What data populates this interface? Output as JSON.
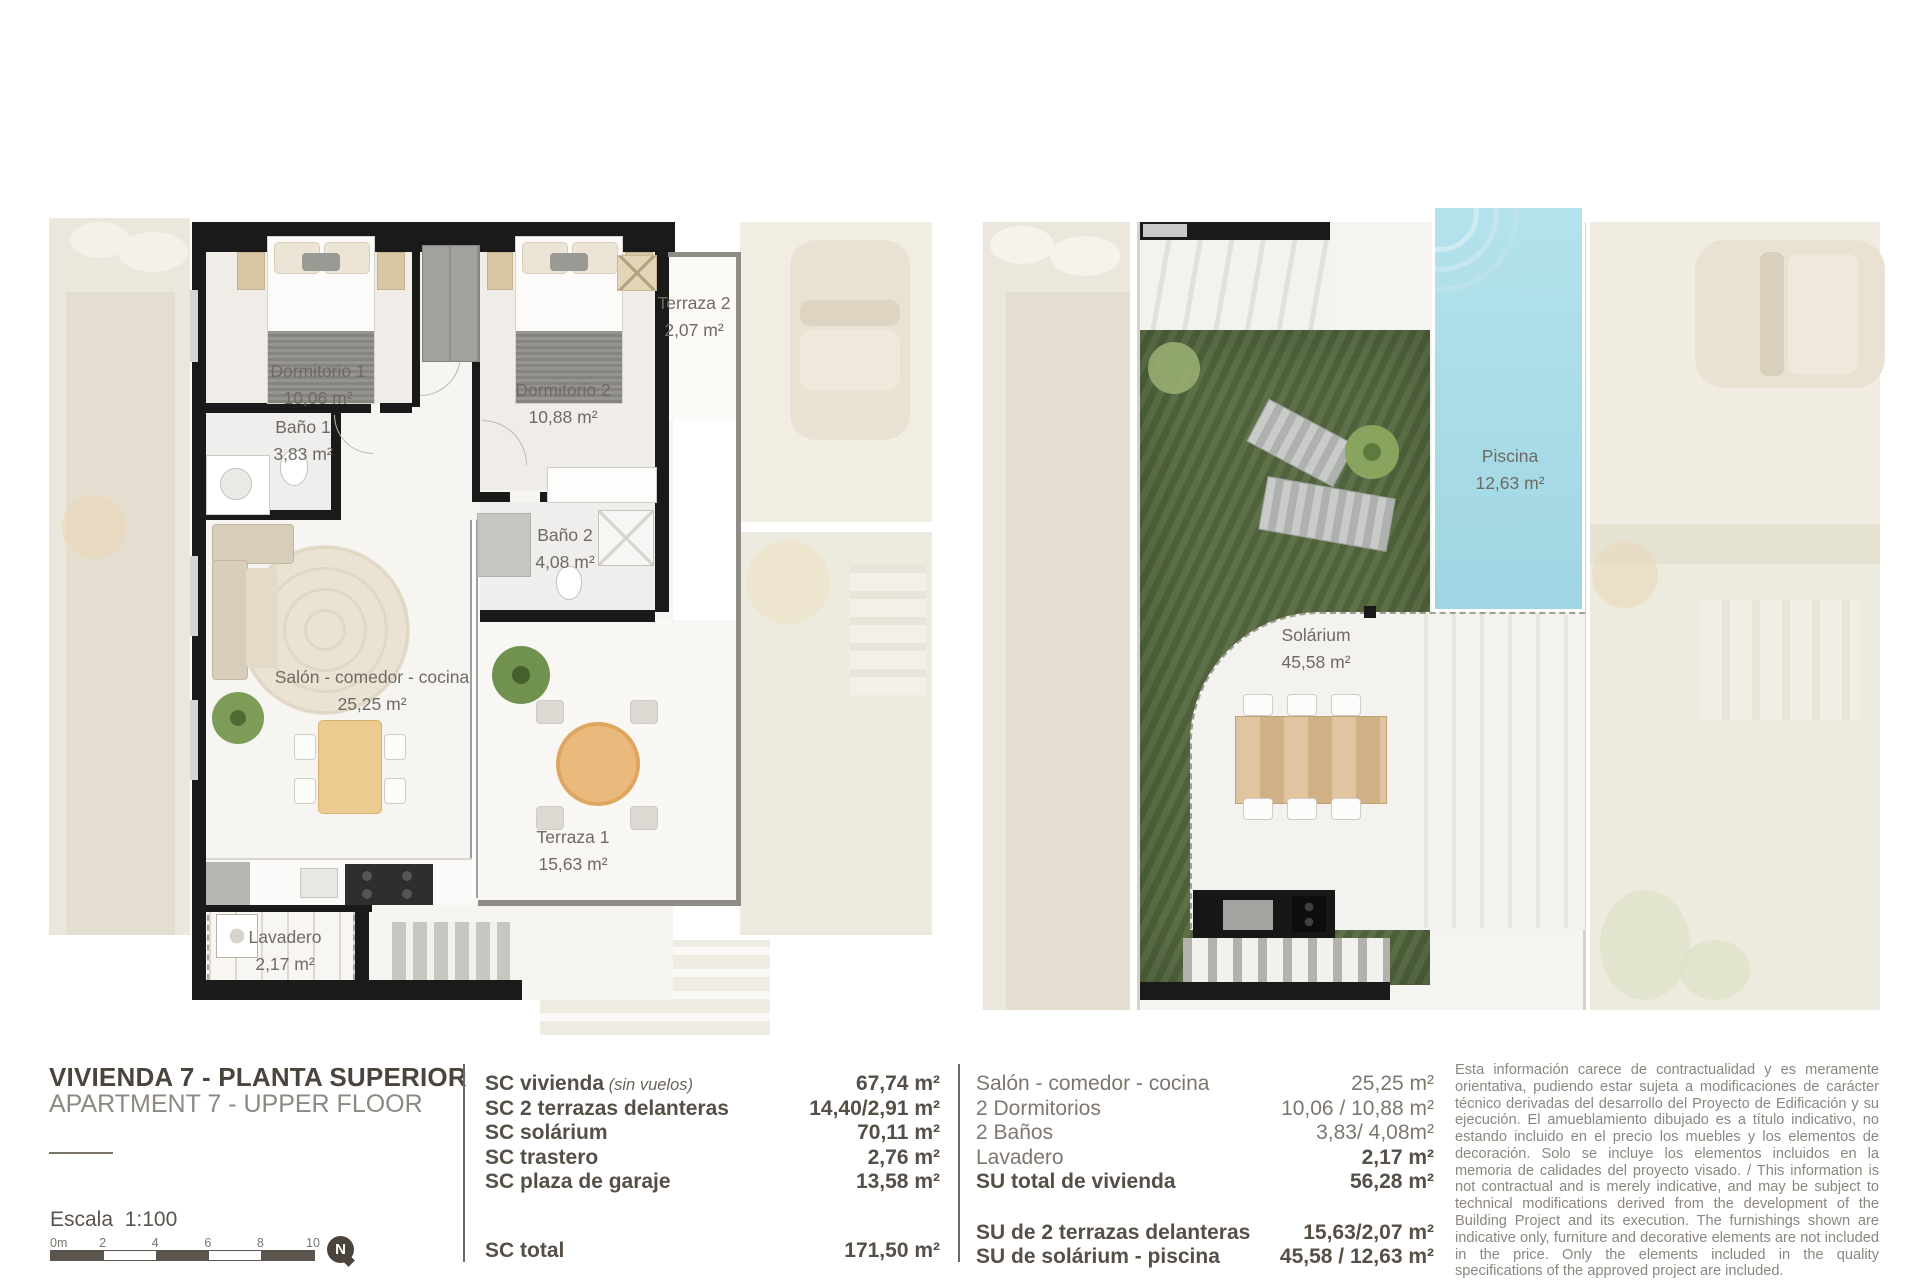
{
  "plans": {
    "left": {
      "rooms": [
        {
          "name": "Dormitorio 1",
          "area": "10,06 m²"
        },
        {
          "name": "Dormitorio 2",
          "area": "10,88 m²"
        },
        {
          "name": "Terraza 2",
          "area": "2,07 m²"
        },
        {
          "name": "Baño 1",
          "area": "3,83 m²"
        },
        {
          "name": "Baño 2",
          "area": "4,08 m²"
        },
        {
          "name": "Salón - comedor - cocina",
          "area": "25,25 m²"
        },
        {
          "name": "Terraza 1",
          "area": "15,63 m²"
        },
        {
          "name": "Lavadero",
          "area": "2,17 m²"
        }
      ]
    },
    "right": {
      "rooms": [
        {
          "name": "Piscina",
          "area": "12,63 m²"
        },
        {
          "name": "Solárium",
          "area": "45,58 m²"
        }
      ]
    }
  },
  "footer": {
    "title": "VIVIENDA 7 - PLANTA SUPERIOR",
    "subtitle": "APARTMENT 7 - UPPER FLOOR",
    "scale_label": "Escala  1:100",
    "scale_ticks": [
      "0m",
      "2",
      "4",
      "6",
      "8",
      "10"
    ],
    "north_label": "N",
    "table_sc": {
      "rows": [
        {
          "label": "SC vivienda",
          "note": "(sin vuelos)",
          "value": "67,74 m²"
        },
        {
          "label": "SC 2 terrazas delanteras",
          "value": "14,40/2,91 m²"
        },
        {
          "label": "SC solárium",
          "value": "70,11 m²"
        },
        {
          "label": "SC trastero",
          "value": "2,76 m²"
        },
        {
          "label": "SC plaza de garaje",
          "value": "13,58 m²"
        },
        {
          "label": "SC total",
          "value": "171,50 m²",
          "gap": true
        }
      ]
    },
    "table_su": {
      "rows": [
        {
          "label": "Salón - comedor - cocina",
          "value": "25,25 m²",
          "bold": false
        },
        {
          "label": "2 Dormitorios",
          "value": "10,06 / 10,88 m²",
          "bold": false
        },
        {
          "label": "2 Baños",
          "value": "3,83/ 4,08m²",
          "bold": false
        },
        {
          "label": "Lavadero",
          "value": "2,17 m²",
          "bold_value": true
        },
        {
          "label": "SU total de vivienda",
          "value": "56,28 m²"
        },
        {
          "label": "SU de 2 terrazas delanteras",
          "value": "15,63/2,07 m²",
          "gap": true
        },
        {
          "label": "SU de solárium - piscina",
          "value": "45,58 / 12,63 m²"
        }
      ]
    },
    "disclaimer": "Esta información carece de contractualidad y es meramente orientativa, pudiendo estar sujeta a modificaciones de carácter técnico derivadas del desarrollo del Proyecto de Edificación y su ejecución. El amueblamiento dibujado es a título indicativo, no estando incluido en el precio los muebles y los elementos de decoración. Solo se incluye los elementos incluidos en la memoria de calidades del proyecto visado. / This information is not contractual and is merely indicative, and may be subject to technical modifications derived from the development of the Building Project and its execution. The furnishings shown are indicative only, furniture and decorative elements are not included in the price. Only the elements included in the quality specifications of the approved project are included."
  },
  "colors": {
    "wall": "#1a1a1a",
    "title_text": "#4b443d",
    "muted_text": "#8d8881",
    "table_text": "#564f47",
    "plan_label": "#6f6a63",
    "grass": "#55693f",
    "pool": "#a8dbe7",
    "fade_beige": "#ebe7dc",
    "wood": "#d9b88b"
  }
}
